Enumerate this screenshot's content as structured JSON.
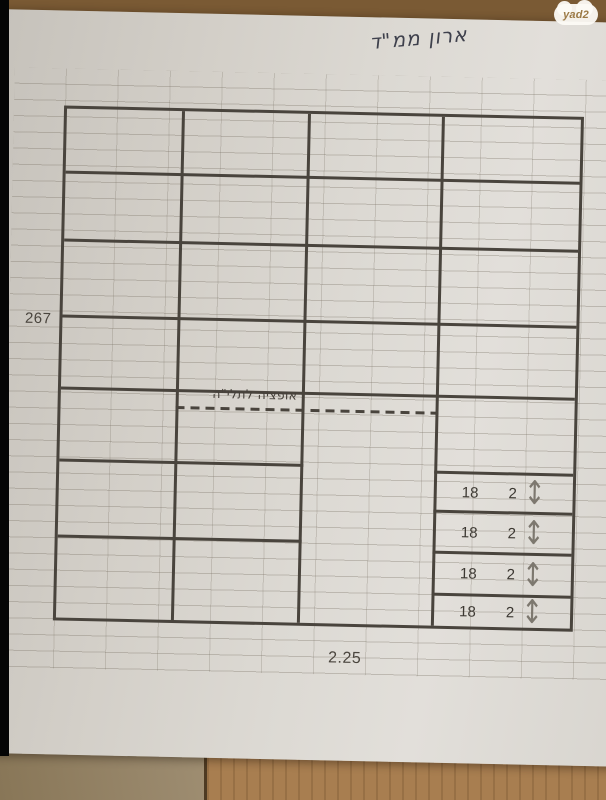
{
  "watermark": {
    "label": "yad2"
  },
  "paper": {
    "handwritten_title": "ארון ממ\"ד",
    "height_label": "267",
    "width_label": "2.25",
    "hanging_note": "אופציה לתלי\"ה"
  },
  "diagram": {
    "type": "closet-front-elevation-sketch",
    "columns": 4,
    "upper_full_width_shelf_rows": 4,
    "left_section_lower_shelf_rows": 3,
    "hanging_section": "middle column open below dashed hanging-rod line",
    "drawers": [
      {
        "depth_label": "18",
        "qty_label": "2",
        "icon": "up-down-arrow-icon"
      },
      {
        "depth_label": "18",
        "qty_label": "2",
        "icon": "up-down-arrow-icon"
      },
      {
        "depth_label": "18",
        "qty_label": "2",
        "icon": "up-down-arrow-icon"
      },
      {
        "depth_label": "18",
        "qty_label": "2",
        "icon": "up-down-arrow-icon"
      }
    ]
  },
  "icons": {
    "up_down_arrow": "↕"
  },
  "colors": {
    "paper": "#dcd9d3",
    "diagram_line": "#49443d",
    "faint_grid_line": "#b3ada2",
    "wood": "#a87e50",
    "badge_text": "#9c7a46",
    "edge_strip": "#050505"
  }
}
